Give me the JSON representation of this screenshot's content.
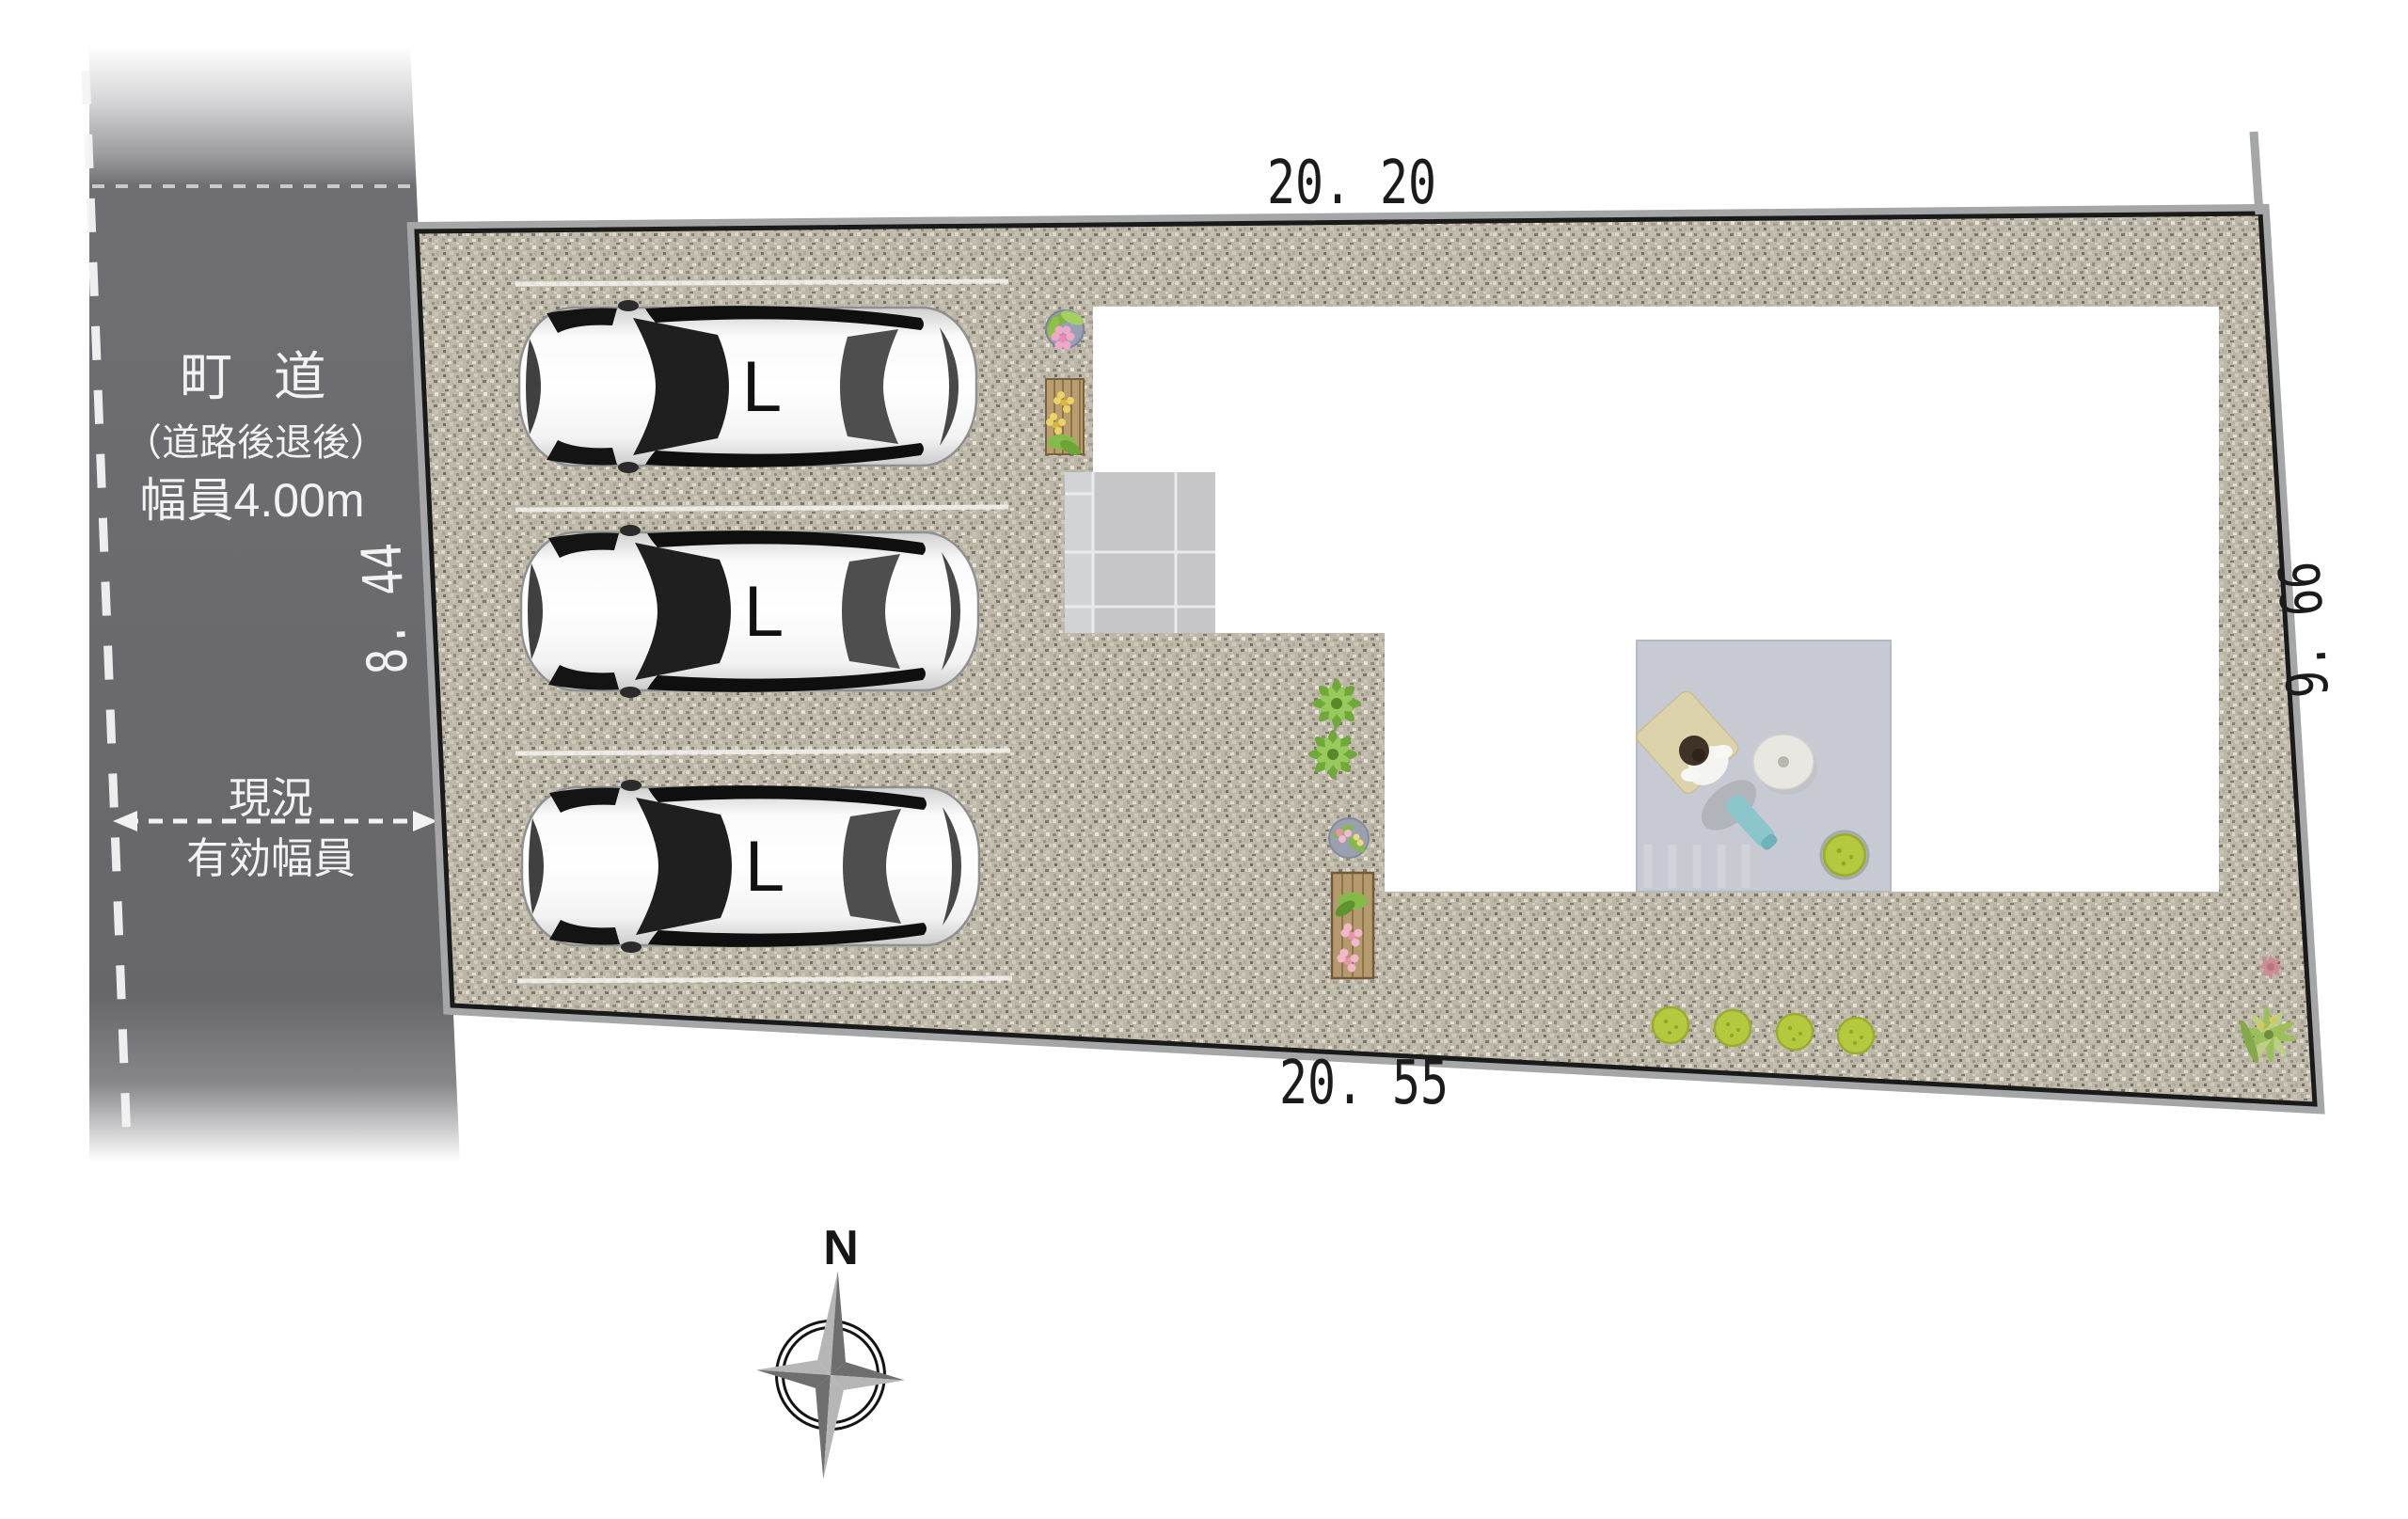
{
  "road": {
    "name": "町 道",
    "setback_note": "（道路後退後）",
    "width_label": "幅員4.00m",
    "status_line1": "現況",
    "status_line2": "有効幅員"
  },
  "dimensions": {
    "top": "20. 20",
    "bottom": "20. 55",
    "left": "8. 44",
    "right": "9. 66"
  },
  "parking": {
    "stall_label": "L"
  },
  "compass": {
    "north": "N"
  },
  "colors": {
    "road": "#69696d",
    "gravel_base": "#bdb7a9",
    "boundary_line": "#1a1a1a",
    "edge_band": "#a4a6a7",
    "building": "#ffffff",
    "terrace": "#c7cad2",
    "porch_tile": "#c6c6c9",
    "bush_green": "#b5c93f",
    "dimension_text": "#1b1b1b",
    "road_text": "#f2f2f2"
  }
}
